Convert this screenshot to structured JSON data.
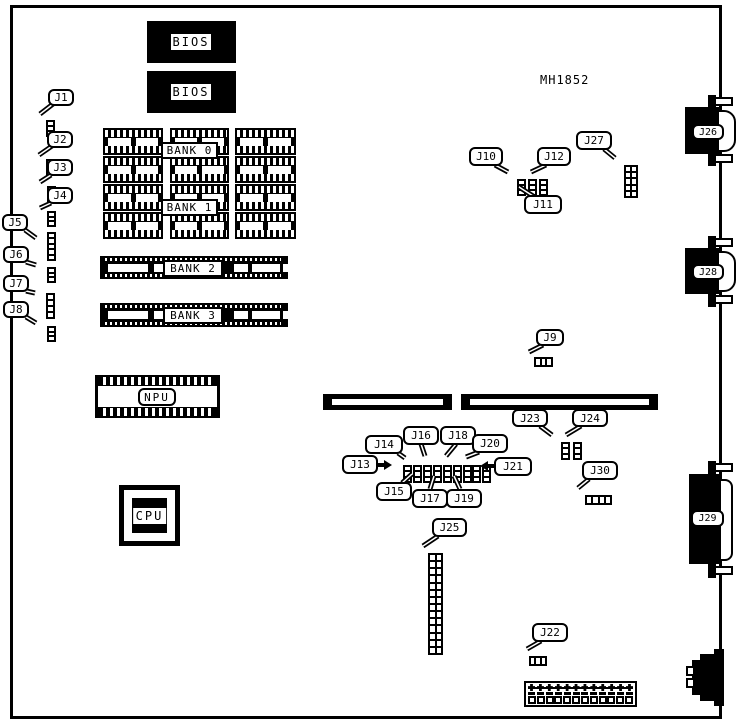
{
  "title": "MH1852",
  "chips": {
    "bios_top": "BIOS",
    "bios_bottom": "BIOS",
    "npu": "NPU",
    "cpu": "CPU"
  },
  "banks": {
    "bank0": "BANK 0",
    "bank1": "BANK 1",
    "bank2": "BANK 2",
    "bank3": "BANK 3"
  },
  "connectors": {
    "j26": "J26",
    "j28": "J28",
    "j29": "J29"
  },
  "callouts": {
    "j1": "J1",
    "j2": "J2",
    "j3": "J3",
    "j4": "J4",
    "j5": "J5",
    "j6": "J6",
    "j7": "J7",
    "j8": "J8",
    "j9": "J9",
    "j10": "J10",
    "j11": "J11",
    "j12": "J12",
    "j13": "J13",
    "j14": "J14",
    "j15": "J15",
    "j16": "J16",
    "j17": "J17",
    "j18": "J18",
    "j19": "J19",
    "j20": "J20",
    "j21": "J21",
    "j22": "J22",
    "j23": "J23",
    "j24": "J24",
    "j25": "J25",
    "j27": "J27",
    "j30": "J30"
  }
}
